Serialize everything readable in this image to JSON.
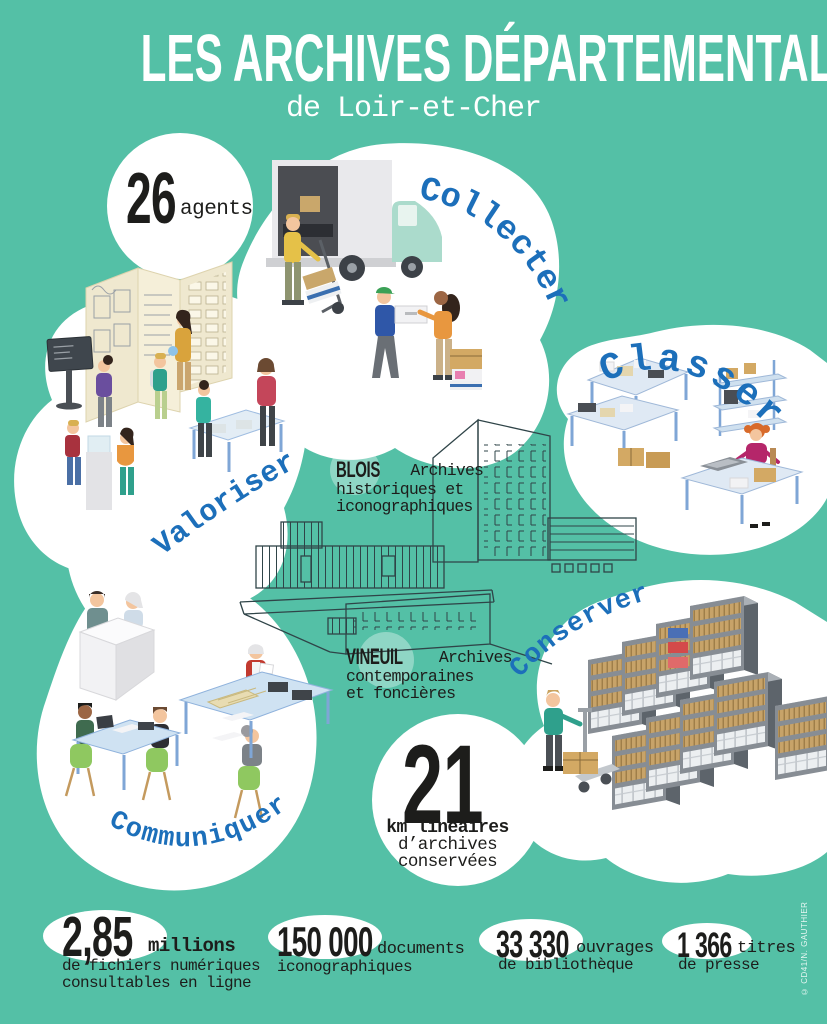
{
  "header": {
    "title": "LES ARCHIVES DÉPARTEMENTALES",
    "subtitle": "de Loir-et-Cher"
  },
  "agents": {
    "value": "26",
    "label": "agents"
  },
  "missions": {
    "collecter": "Collecter",
    "classer": "Classer",
    "valoriser": "Valoriser",
    "conserver": "Conserver",
    "communiquer": "Communiquer"
  },
  "sites": {
    "blois": {
      "name": "BLOIS",
      "line1": "Archives",
      "line2": "historiques et",
      "line3": "iconographiques"
    },
    "vineuil": {
      "name": "VINEUIL",
      "line1": "Archives",
      "line2": "contemporaines",
      "line3": "et foncières"
    }
  },
  "linear_km": {
    "value": "21",
    "unit": "km linéaires",
    "line2": "d’archives",
    "line3": "conservées"
  },
  "footer_stats": [
    {
      "value": "2,85",
      "suffix": "millions",
      "line1": "de fichiers numériques",
      "line2": "consultables en ligne"
    },
    {
      "value": "150 000",
      "suffix": "documents",
      "line1": "iconographiques",
      "line2": ""
    },
    {
      "value": "33 330",
      "suffix": "ouvrages",
      "line1": "de bibliothèque",
      "line2": ""
    },
    {
      "value": "1 366",
      "suffix": "titres",
      "line1": "de presse",
      "line2": ""
    }
  ],
  "credit": "© CD41/N. GAUTHIER",
  "colors": {
    "background": "#54C0A6",
    "label_blue": "#1C6FBA",
    "text_black": "#1D1D1B",
    "blob_white": "#FFFFFF",
    "sketch_line": "#2F4448"
  },
  "illustrations": [
    "truck-unloading-scene",
    "sorting-tables-scene",
    "exhibition-visitors-scene",
    "archive-shelving-scene",
    "reading-room-scene",
    "archive-buildings-sketch"
  ]
}
